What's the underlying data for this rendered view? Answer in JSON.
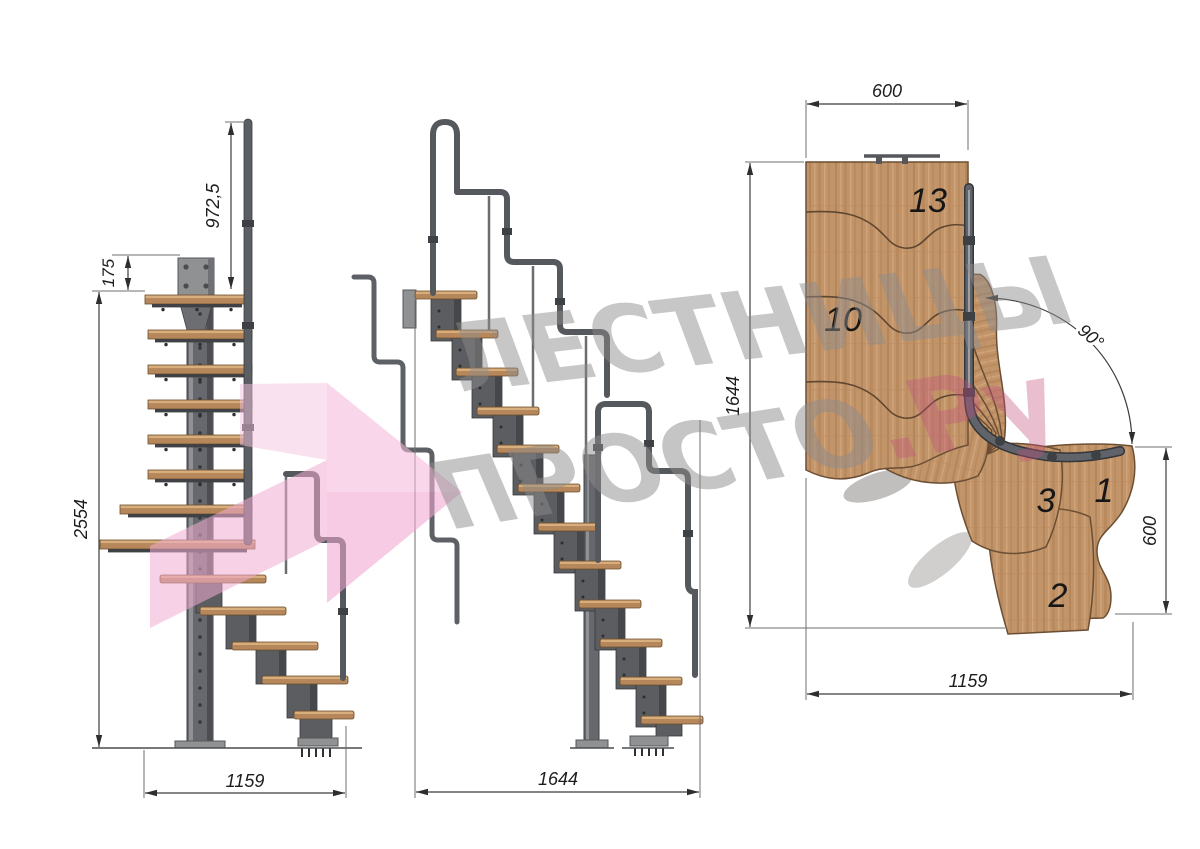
{
  "views": {
    "front": {
      "dim_rail_height": "972,5",
      "dim_plate_offset": "175",
      "dim_total_height": "2554",
      "dim_width": "1159"
    },
    "side": {
      "dim_length": "1644"
    },
    "plan": {
      "dim_platform_width": "600",
      "dim_length": "1644",
      "dim_turn_angle": "90°",
      "dim_exit_width": "600",
      "dim_width": "1159",
      "step_labels": {
        "step13": "13",
        "step10": "10",
        "step3": "3",
        "step1": "1",
        "step2": "2"
      }
    }
  },
  "watermark": {
    "line1": "ЛЕСТНИЦЫ",
    "line2": "ПРОСТО",
    "suffix": ".Ру",
    "gray": "#8e8c8c",
    "pink_head_light": "#f5b9da",
    "pink_head_dark": "#efa6cf",
    "pink_tail": "#f0abd2",
    "pink_fold": "#f6c3e0",
    "accent": "#c4517f"
  },
  "colors": {
    "wood": "#c2946a",
    "wood_dark": "#8a6743",
    "steel": "#5d5f63",
    "steel_dark": "#3e4043",
    "dimension": "#3c3c3c",
    "background": "#ffffff"
  }
}
